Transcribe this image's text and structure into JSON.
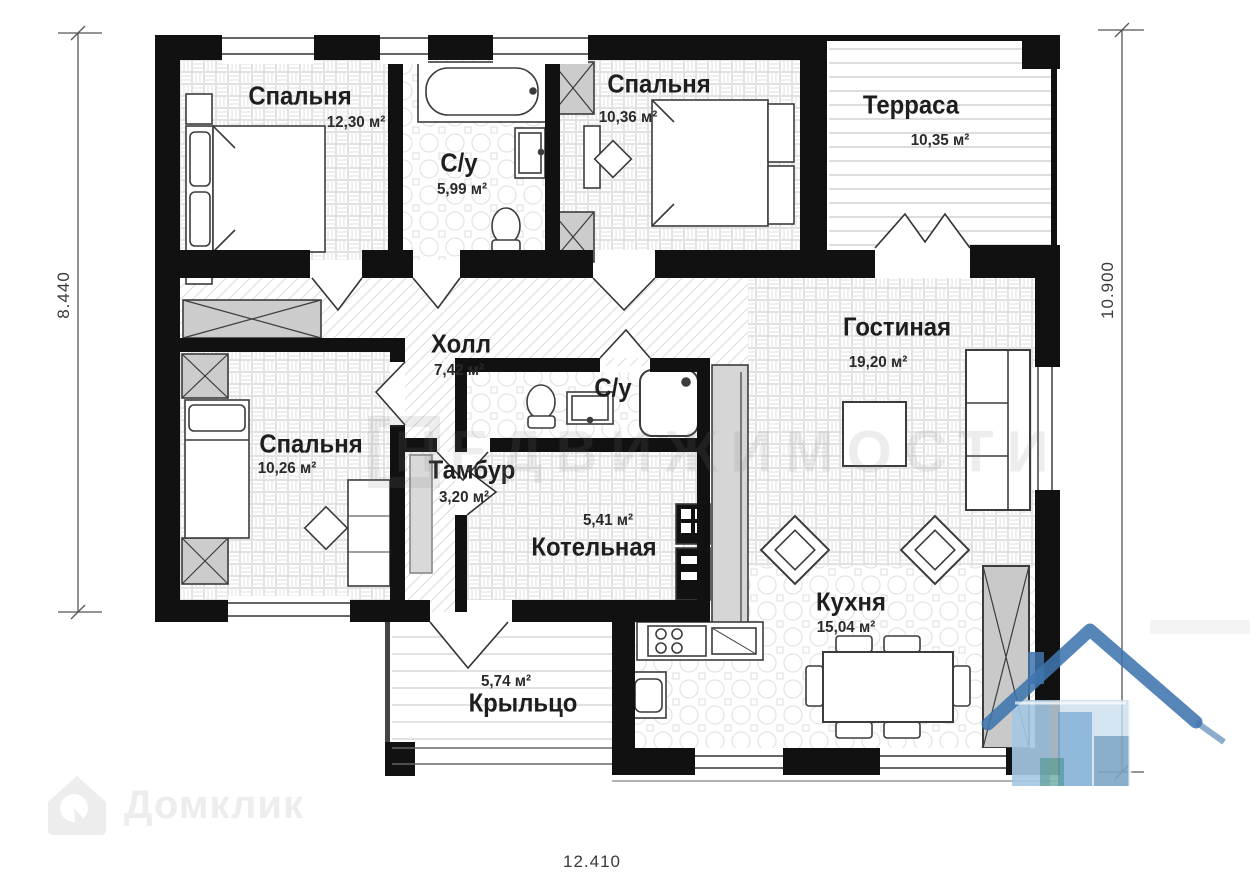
{
  "plan": {
    "rooms": [
      {
        "id": "bedroom-1",
        "name": "Спальня",
        "area": "12,30 м²"
      },
      {
        "id": "bathroom-1",
        "name": "С/у",
        "area": "5,99 м²"
      },
      {
        "id": "bedroom-2",
        "name": "Спальня",
        "area": "10,36 м²"
      },
      {
        "id": "terrace",
        "name": "Терраса",
        "area": "10,35 м²"
      },
      {
        "id": "hall",
        "name": "Холл",
        "area": "7,42 м²"
      },
      {
        "id": "living-room",
        "name": "Гостиная",
        "area": "19,20 м²"
      },
      {
        "id": "bedroom-3",
        "name": "Спальня",
        "area": "10,26 м²"
      },
      {
        "id": "vestibule",
        "name": "Тамбур",
        "area": "3,20 м²"
      },
      {
        "id": "bathroom-2",
        "name": "С/у",
        "area": ""
      },
      {
        "id": "boiler-room",
        "name": "Котельная",
        "area": "5,41 м²"
      },
      {
        "id": "kitchen",
        "name": "Кухня",
        "area": "15,04 м²"
      },
      {
        "id": "porch",
        "name": "Крыльцо",
        "area": "5,74 м²"
      }
    ],
    "dimensions": {
      "left": "8.440",
      "right": "10.900",
      "bottom": "12.410"
    },
    "watermarks": {
      "brand": "Домклик",
      "center": "НЕДВИЖИМОСТИ"
    },
    "colors": {
      "wall": "#111111",
      "furniture_gray": "#cccccc",
      "watermark_blue": "#3f74ae"
    }
  }
}
